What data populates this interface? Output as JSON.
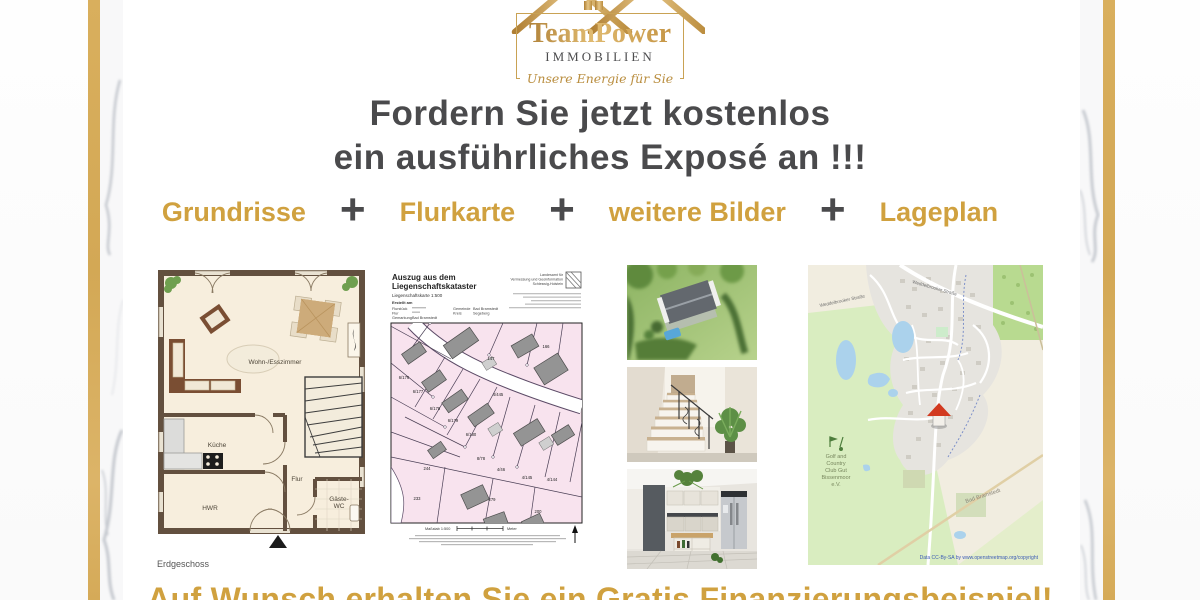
{
  "logo": {
    "brand": "TeamPower",
    "subtitle": "IMMOBILIEN",
    "tagline": "Unsere Energie für Sie"
  },
  "headline": {
    "line1": "Fordern Sie jetzt kostenlos",
    "line2": "ein ausführliches Exposé an !!!"
  },
  "features": {
    "items": [
      "Grundrisse",
      "Flurkarte",
      "weitere Bilder",
      "Lageplan"
    ],
    "separator": "+"
  },
  "floorplan": {
    "rooms": {
      "living": "Wohn-/Esszimmer",
      "kitchen": "Küche",
      "hall": "Flur",
      "utility": "HWR",
      "wc_line1": "Gäste-",
      "wc_line2": "WC"
    },
    "caption": "Erdgeschoss"
  },
  "cadastral": {
    "title_line1": "Auszug aus dem",
    "title_line2": "Liegenschaftskataster",
    "scale_line": "Liegenschaftskarte 1:500",
    "erstellt": "Erstellt am",
    "flurstueck_label": "Flurstück",
    "flur_label": "Flur",
    "gemarkung_label": "Gemarkung",
    "gemarkung_value": "Bad Bramstedt",
    "gemeinde_label": "Gemeinde",
    "gemeinde_value": "Bad Bramstedt",
    "kreis_label": "Kreis",
    "kreis_value": "Segeberg",
    "agency_line1": "Landesamt für",
    "agency_line2": "Vermessung und Geoinformation",
    "agency_line3": "Schleswig-Holstein",
    "massstab": "Maßstab 1:500",
    "meter": "Meter",
    "parcels": [
      "6/176",
      "6/177",
      "6/178",
      "6/179",
      "6/180",
      "4/445",
      "147",
      "166",
      "8/78",
      "4/46",
      "4/145",
      "4/144",
      "244",
      "233",
      "279",
      "200"
    ]
  },
  "map": {
    "golf_line1": "Golf and",
    "golf_line2": "Country",
    "golf_line3": "Club Gut",
    "golf_line4": "Bissenmoor",
    "golf_line5": "e.V.",
    "town": "Bad Bramstedt",
    "street1": "Weddelbrooker Straße",
    "street2": "Weddelbrooker Straße",
    "copyright": "Data CC-By-SA by www.openstreetmap.org/copyright"
  },
  "footer": {
    "text": "Auf Wunsch erhalten Sie ein Gratis Finanzierungsbeispiel!"
  },
  "colors": {
    "gold_accent": "#d0a13f",
    "gold_stripe": "#d8ae5f",
    "headline_gray": "#4a4a4c",
    "cadastral_pink": "#f8e3ee",
    "map_green": "#d9edc0"
  }
}
